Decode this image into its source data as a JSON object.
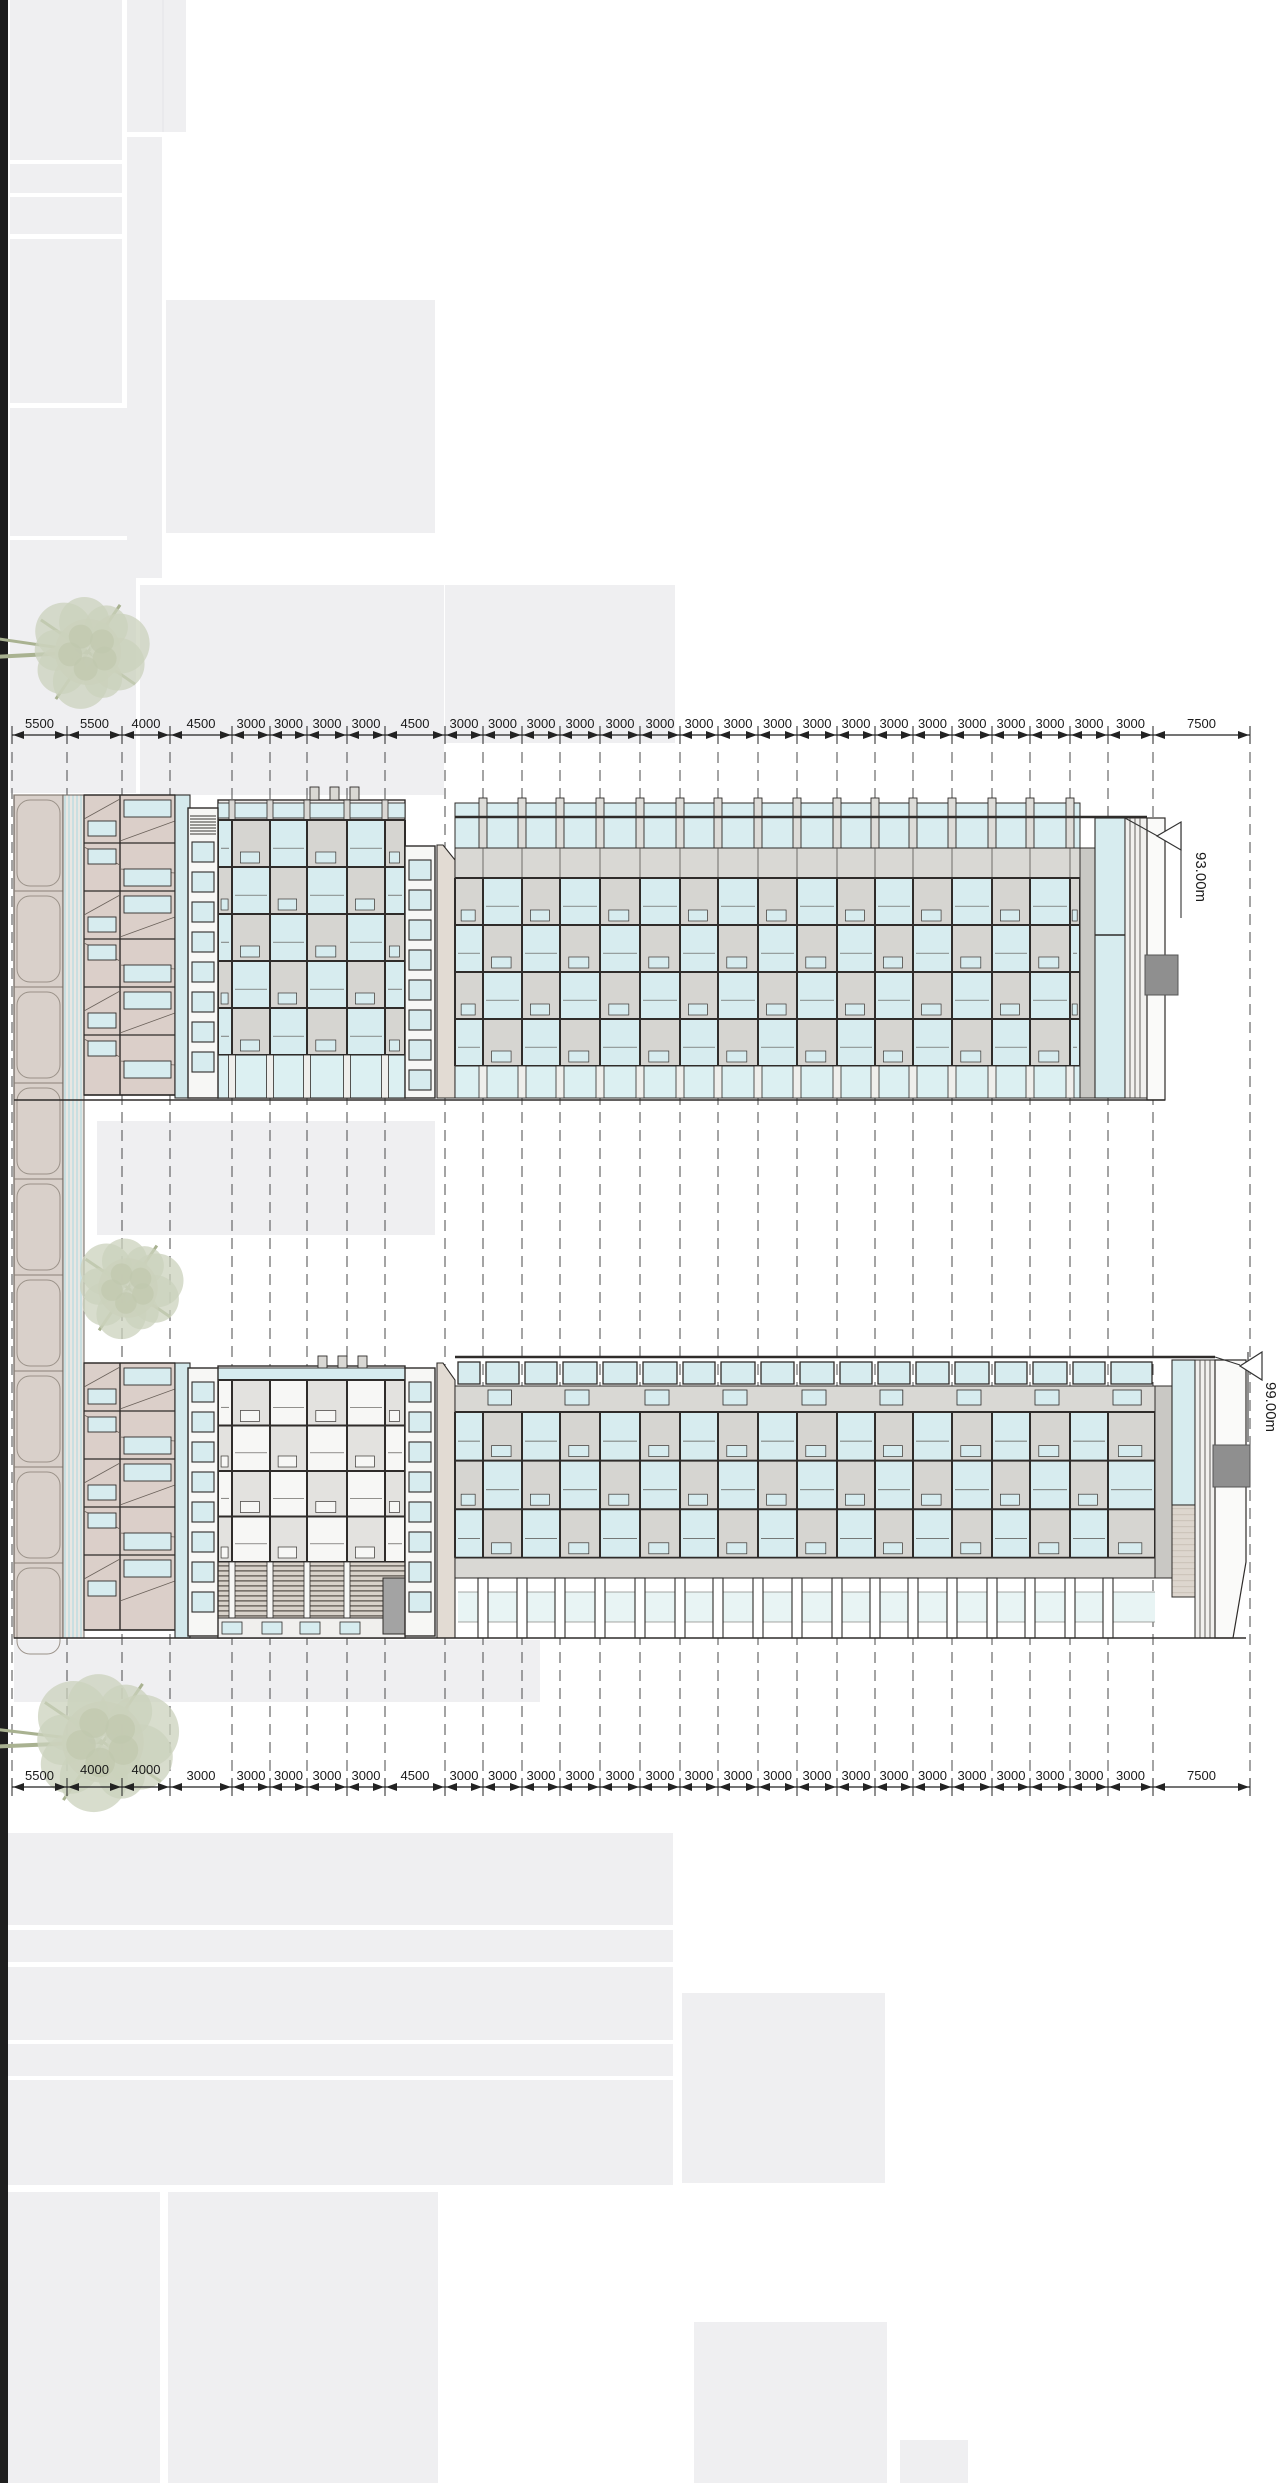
{
  "document": {
    "type": "architectural-elevation-drawing",
    "views": [
      "upper-elevation",
      "lower-elevation"
    ]
  },
  "dimensions_top": [
    "5500",
    "5500",
    "4000",
    "4500",
    "3000",
    "3000",
    "3000",
    "3000",
    "4500",
    "3000",
    "3000",
    "3000",
    "3000",
    "3000",
    "3000",
    "3000",
    "3000",
    "3000",
    "3000",
    "3000",
    "3000",
    "3000",
    "3000",
    "3000",
    "3000",
    "3000",
    "3000",
    "7500"
  ],
  "dimensions_bottom": [
    "5500",
    "4000",
    "4000",
    "3000",
    "3000",
    "3000",
    "3000",
    "3000",
    "4500",
    "3000",
    "3000",
    "3000",
    "3000",
    "3000",
    "3000",
    "3000",
    "3000",
    "3000",
    "3000",
    "3000",
    "3000",
    "3000",
    "3000",
    "3000",
    "3000",
    "3000",
    "3000",
    "7500"
  ],
  "elevation_markers": {
    "upper": {
      "label": "93.00m",
      "icon": "level-triangle-icon"
    },
    "lower": {
      "label": "99.00m",
      "icon": "level-triangle-icon"
    }
  },
  "colors": {
    "context": "#efeff1",
    "line": "#2f2c2a",
    "dim_line": "#222222",
    "glass": "#d7ecef",
    "glass_band": "#d9edf0",
    "glass_pale": "#e8f4f4",
    "panel": "#d6d5d1",
    "spandrel": "#d9d8d4",
    "beige": "#dbcfc9",
    "beige_wall": "#e2dbd3",
    "strip_panel": "#d9d0ca",
    "stripe_blue": "#c9dfe1",
    "white_wall": "#fafaf9",
    "pier": "#c9c8c4",
    "dark_box": "#8f8f8f",
    "tree": "#cbd1bc",
    "branch": "#a9b291",
    "black_bar": "#1f1f1f"
  }
}
